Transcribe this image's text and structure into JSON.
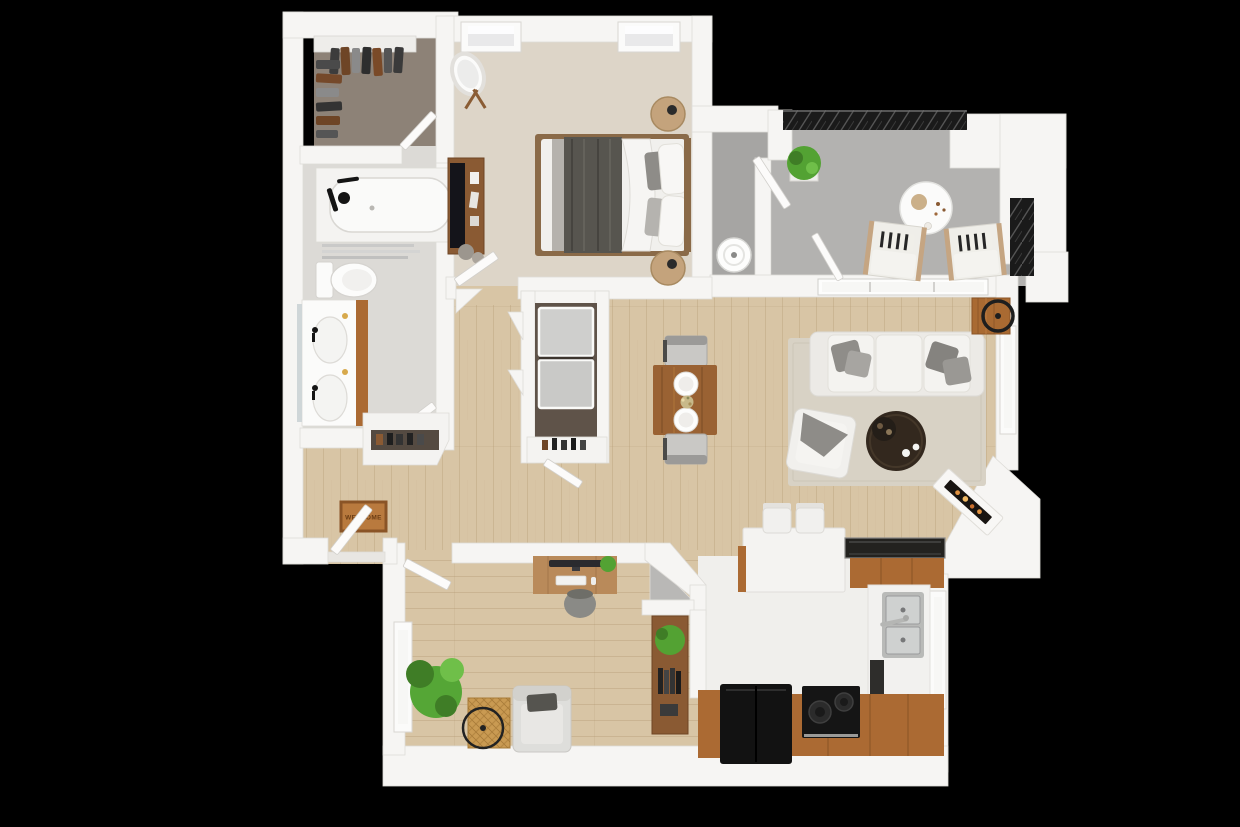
{
  "image": {
    "type": "3d-floor-plan-top-down-render",
    "description": "Top-down 3D rendered floor plan of a one-bedroom apartment with den, shown on a black background"
  },
  "palette": {
    "background": "#000000",
    "wall": "#f6f5f3",
    "wallShadow": "#d9d7d3",
    "woodFloor": "#d8c5a5",
    "plankLine": "#b39a74",
    "bedroomCarpet": "#ddd5c8",
    "closetCarpet": "#8d8277",
    "bathroomFloor": "#dcdad6",
    "balconyFloor": "#b3b2b0",
    "utilityFloor": "#a6a5a3",
    "kitchenFloor": "#f0efec",
    "cabinetWood": "#ab6a33",
    "darkCounter": "#23221f",
    "applianceBlack": "#121212",
    "fabricWhite": "#f1f0ed",
    "cushionGray": "#8e8c88",
    "rug": "#d8d2c5",
    "coffeeTable": "#33281e",
    "diningTable": "#9a6233",
    "deskWood": "#b98a5a",
    "railing": "#1a1a1a",
    "plantGreen": "#53a233",
    "matBrown": "#b97a3e",
    "flame": "#e09140",
    "glass": "#f7f7f5",
    "stainless": "#b9bab8"
  },
  "entry": {
    "door_mat_text": "WELCOME"
  },
  "rooms": [
    {
      "id": "walk-in-closet",
      "label": "Walk-in Closet",
      "furniture": [
        "hanging-clothes",
        "closet-shelf",
        "door"
      ]
    },
    {
      "id": "bathroom",
      "label": "Bathroom",
      "furniture": [
        "bathtub",
        "shower-screen",
        "toilet",
        "double-sink-vanity",
        "mirror",
        "door"
      ]
    },
    {
      "id": "primary-bedroom",
      "label": "Bedroom",
      "furniture": [
        "bed",
        "nightstand-top",
        "nightstand-bottom",
        "dresser-with-tv",
        "standing-mirror",
        "two-windows",
        "door"
      ]
    },
    {
      "id": "utility-closet",
      "label": "Utility Closet",
      "furniture": [
        "water-heater"
      ]
    },
    {
      "id": "balcony",
      "label": "Balcony",
      "furniture": [
        "lounge-chair-left",
        "lounge-chair-right",
        "round-table",
        "potted-plant",
        "metal-railing",
        "door"
      ]
    },
    {
      "id": "hallway",
      "label": "Hallway",
      "furniture": [
        "corner-shelves"
      ]
    },
    {
      "id": "laundry-closet",
      "label": "Laundry Closet",
      "furniture": [
        "washer",
        "dryer",
        "storage-shelf",
        "door"
      ]
    },
    {
      "id": "living-room",
      "label": "Living Room",
      "furniture": [
        "sofa",
        "area-rug",
        "round-coffee-table",
        "armchair",
        "side-table",
        "corner-fireplace",
        "sliding-glass-door",
        "window"
      ]
    },
    {
      "id": "dining-area",
      "label": "Dining Area",
      "furniture": [
        "dining-table",
        "chair-top",
        "chair-bottom",
        "place-settings"
      ]
    },
    {
      "id": "kitchen",
      "label": "Kitchen",
      "furniture": [
        "island-with-stools",
        "bar-counter",
        "double-sink",
        "dishwasher",
        "refrigerator",
        "range",
        "wood-cabinets",
        "window"
      ]
    },
    {
      "id": "den-office",
      "label": "Den / Office",
      "furniture": [
        "desk",
        "monitor",
        "desk-chair",
        "armchair",
        "rattan-side-table",
        "floor-plant",
        "bookshelf",
        "corner-closet",
        "window",
        "door"
      ]
    },
    {
      "id": "entry",
      "label": "Entry",
      "furniture": [
        "front-door",
        "welcome-mat",
        "shoe-shelf"
      ]
    }
  ]
}
